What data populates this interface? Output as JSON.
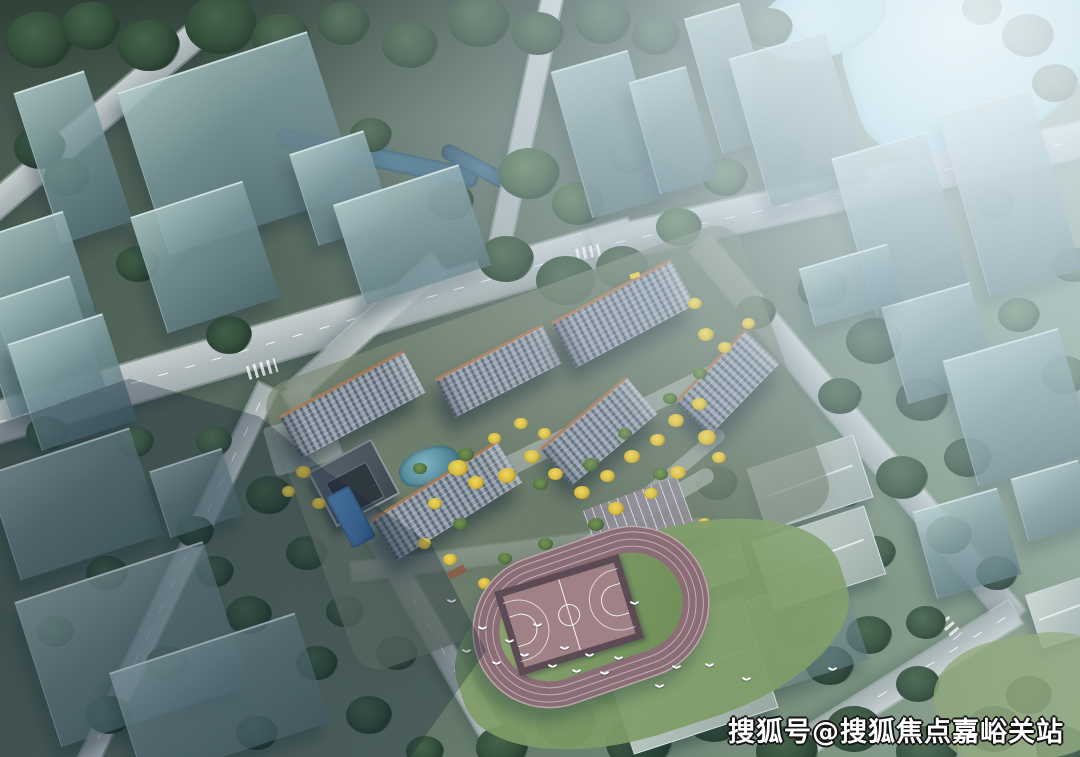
{
  "scene": {
    "type": "aerial-3d-architectural-rendering",
    "subject": "residential development masterplan surrounded by translucent context massing blocks",
    "features": [
      "six mid-rise residential buildings with terracotta trim",
      "landscaped courtyard with yellow and green trees",
      "clubhouse with swimming pool and lap pool",
      "oval running track with basketball court",
      "white birds in flight",
      "tree-lined roads with lane markings",
      "river pond at top right",
      "large diagonal ground shadow at lower left"
    ]
  },
  "watermark": {
    "text": "搜狐号@搜狐焦点嘉峪关站"
  },
  "palette": {
    "road_grey": "#b0babc",
    "road_light": "#c6cecf",
    "glass_block": "#6e939c",
    "water_light": "#9fd0de",
    "canal_dark": "#497489",
    "facade_grey": "#93a0ab",
    "facade_shade": "#5e6a76",
    "roof_light": "#cdd2d6",
    "trim_terracotta": "#a87a58",
    "tree_yellow": "#d9bc3f",
    "tree_dark": "#35503c",
    "track_mauve": "#8b6e75",
    "infield_green": "#6f8d58",
    "court_mauve": "#a08286",
    "court_border": "#5c4a55",
    "pool_blue": "#3d6fa6",
    "pond_teal": "#4e8596",
    "bird_white": "#ffffff",
    "watermark_fill": "#ffffff",
    "watermark_outline": "#141414"
  }
}
